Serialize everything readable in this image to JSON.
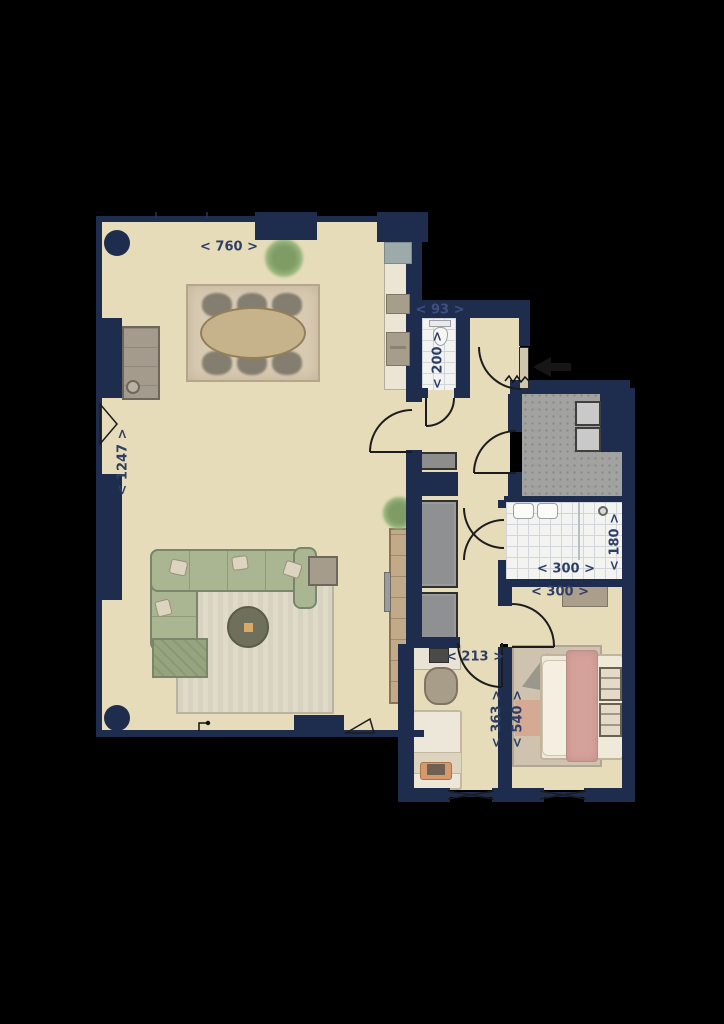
{
  "plan": {
    "type": "apartment-floor-plan",
    "dimensions": {
      "living_width": "< 760 >",
      "living_depth": "< 1247 >",
      "wc_width": "< 93 >",
      "wc_depth": "< 200 >",
      "bathroom_width": "< 300 >",
      "bathroom_depth": "< 180 >",
      "bedroom_width": "< 300 >",
      "study_nook_width": "< 213 >",
      "study_depth": "< 363 >",
      "bedroom_depth": "< 540 >"
    },
    "colors": {
      "background": "#000000",
      "wall": "#1e2c4e",
      "floor": "#e6dcba",
      "tile_floor": "#f3f3f1",
      "terrace_floor": "#a2a2a0",
      "dimension_text": "#2e3f66",
      "sofa_green": "#a9b691",
      "bed_blanket_pink": "#d5a19b",
      "wood": "#c6b28b"
    }
  }
}
